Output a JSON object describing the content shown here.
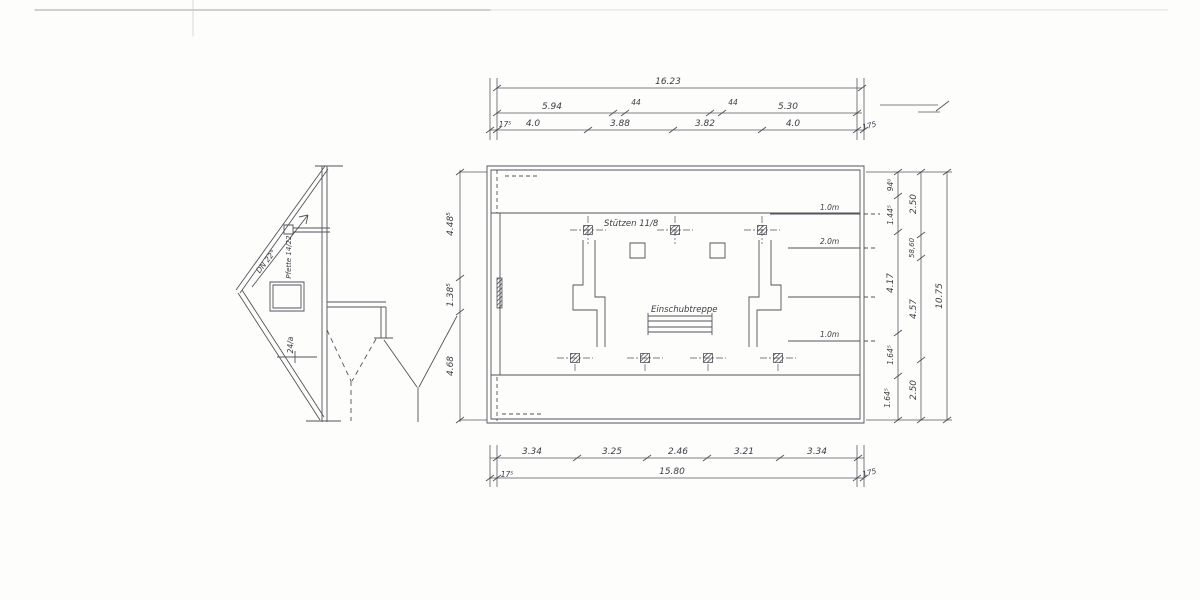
{
  "top_dim": {
    "total": "16.23",
    "row2": [
      "5.94",
      "44",
      "44",
      "5.30"
    ],
    "row3": [
      "17⁵",
      "4.0",
      "3.88",
      "3.82",
      "4.0",
      "175"
    ]
  },
  "bottom_dim": {
    "segments": [
      "3.34",
      "3.25",
      "2.46",
      "3.21",
      "3.34"
    ],
    "total": "15.80",
    "left_end": "17⁵",
    "right_end": "175"
  },
  "left_dim": [
    "4.48⁵",
    "1.38⁵",
    "4.68"
  ],
  "right_dim": {
    "inner": [
      "94⁰",
      "1.44⁵",
      "4.17",
      "1.64⁵",
      "1.64⁵"
    ],
    "middle": [
      "2.50",
      "58,60",
      "4.57",
      "2.50"
    ],
    "outer": "10.75"
  },
  "plan": {
    "columns_label": "Stützen 11/8",
    "stair_label": "Einschubtreppe",
    "height_marks": [
      "1.0m",
      "2.0m",
      "1.0m"
    ]
  },
  "section": {
    "roof_pitch": "DN 22°",
    "purlin_label": "Pfette 14/22",
    "rafter_label": "24/a"
  },
  "colors": {
    "ink": "#3c3c46",
    "paper": "#fdfdfb"
  }
}
